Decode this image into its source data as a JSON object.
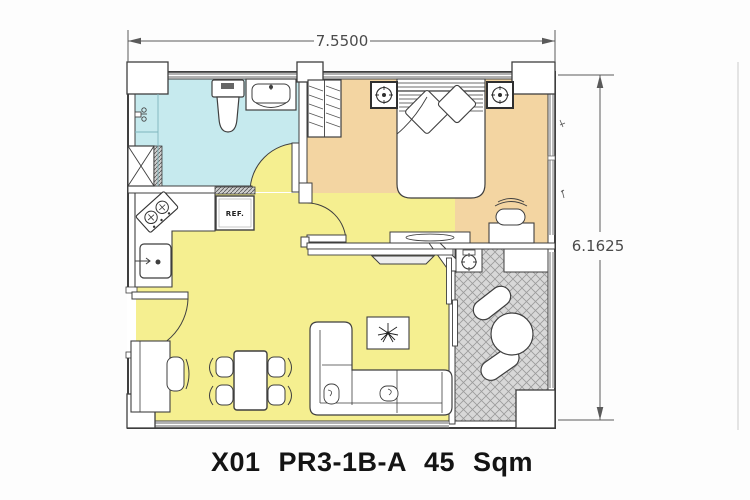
{
  "title": "X01 PR3-1B-A 45 Sqm",
  "dimensions": {
    "width_label": "7.5500",
    "height_label": "6.1625"
  },
  "appliances": {
    "refrigerator_label": "REF."
  },
  "colors": {
    "bathroom_floor": "#c6eaee",
    "bedroom_floor": "#f3d5a2",
    "living_kitchen_floor": "#f5ef90",
    "balcony_floor": "#d8d8d8",
    "wall_line": "#3f3f3f",
    "dimension_text": "#4a4a4a",
    "title_text": "#141414"
  }
}
